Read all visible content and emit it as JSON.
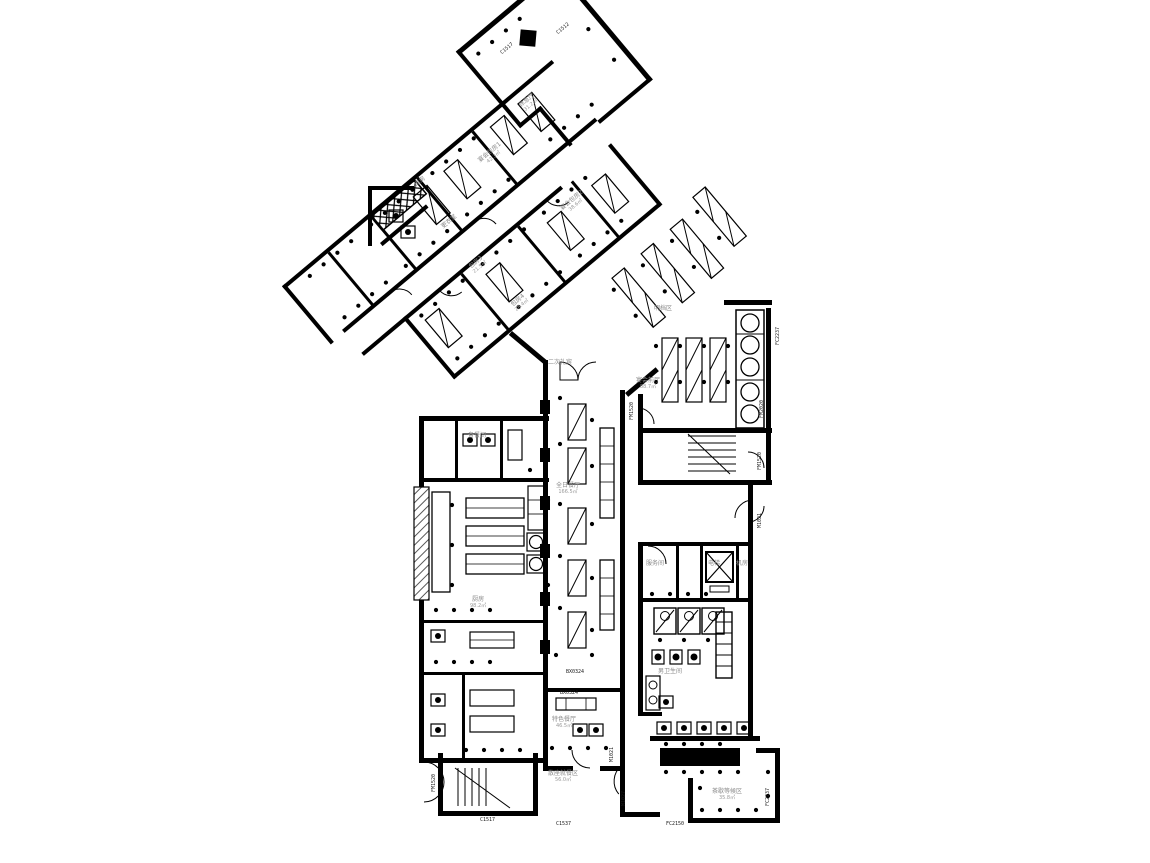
{
  "document": {
    "kind": "architectural-floor-plan",
    "style": "black-and-white CAD drawing",
    "ink_color": "#000000",
    "label_color": "#8a8a8a",
    "background": "#ffffff"
  },
  "rooms": {
    "concierge": {
      "name": "二次礼宾"
    },
    "banquet_foyer": {
      "name": "宴会前厅",
      "area": "88.7㎡"
    },
    "all_day_dining": {
      "name": "全日餐厅",
      "area": "166.5㎡"
    },
    "specialty": {
      "name": "特色餐厅",
      "area": "46.5㎡"
    },
    "seating_area": {
      "name": "散座就餐区",
      "area": "56.0㎡"
    },
    "tea_lounge": {
      "name": "茶歇等候区",
      "area": "35.8㎡"
    },
    "kitchen": {
      "name": "厨房",
      "area": "98.2㎡"
    },
    "pantry": {
      "name": "备餐间"
    },
    "elevator": {
      "name": "电梯"
    },
    "machine_room": {
      "name": "机房"
    },
    "service_room": {
      "name": "服务间"
    },
    "mens_wc": {
      "name": "男卫生间"
    },
    "wing_room_1": {
      "name": "宴会包房1",
      "area": "42.3㎡"
    },
    "wing_room_2": {
      "name": "宴会包房2",
      "area": "38.6㎡"
    },
    "wing_head": {
      "name": "休息厅",
      "area": "31.2㎡"
    },
    "wing_store": {
      "name": "库房"
    },
    "wing_locker": {
      "name": "更衣室"
    },
    "wing_room_3": {
      "name": "包房3",
      "area": "21.5㎡"
    },
    "wing_room_4": {
      "name": "包房4",
      "area": "28.4㎡"
    },
    "buffet": {
      "name": "明档区"
    }
  },
  "tags": {
    "bx0324a": "BX0324",
    "bx0324b": "BX0324",
    "c1517a": "C1517",
    "c1517b": "C1517",
    "c1512": "C1512",
    "c1537": "C1537",
    "m1027": "M1027",
    "m1021a": "M1021",
    "m1021b": "M1021",
    "fc2150": "FC2150",
    "fc2237a": "FC2237",
    "fc2237b": "FC2237",
    "fm1520a": "FM1520",
    "fm1520b": "FM1520",
    "fm1520c": "FM1520",
    "fm2020": "FM2020"
  }
}
